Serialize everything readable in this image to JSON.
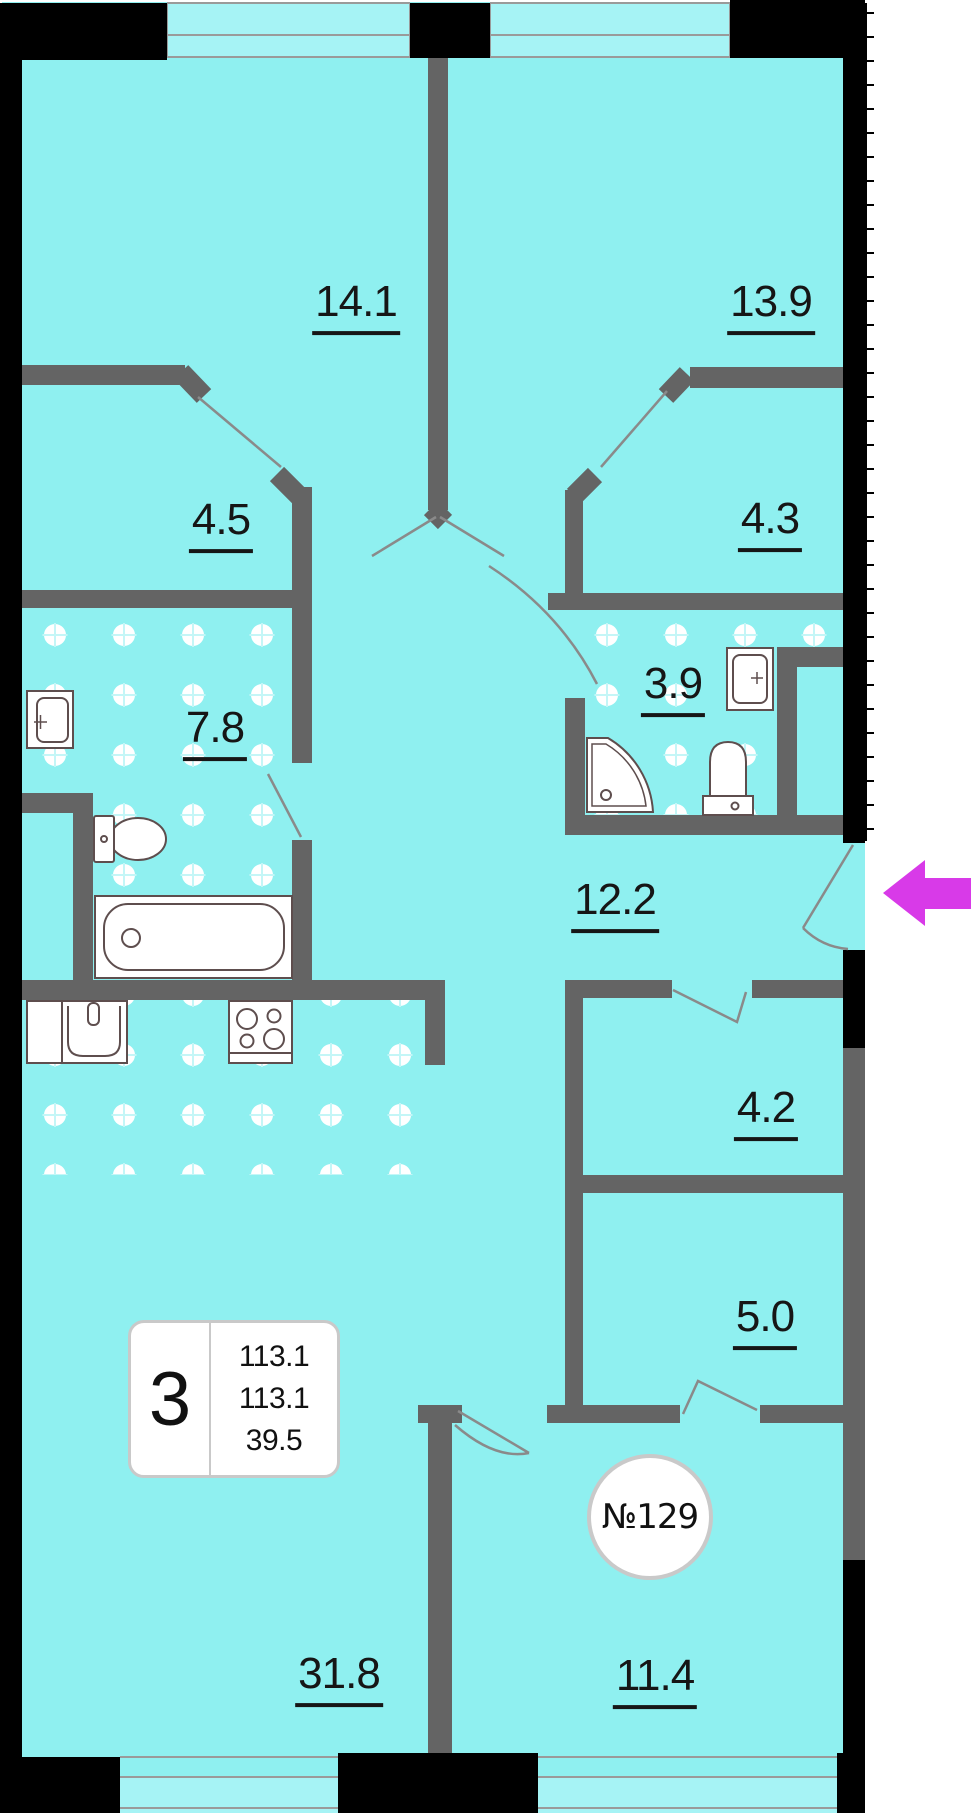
{
  "floor_plan": {
    "unit_number": "№129",
    "info_badge": {
      "rooms_count": "3",
      "values": [
        "113.1",
        "113.1",
        "39.5"
      ]
    },
    "room_areas": {
      "bedroom_top_left": "14.1",
      "bedroom_top_right": "13.9",
      "closet_left": "4.5",
      "closet_right": "4.3",
      "bathroom_small": "3.9",
      "bathroom_large": "7.8",
      "hallway": "12.2",
      "storage": "4.2",
      "wardrobe": "5.0",
      "living_kitchen": "31.8",
      "bedroom_bottom": "11.4"
    },
    "colors": {
      "floor": "#8FF0F0",
      "window_glass": "#A6F3F5",
      "outer_wall": "#000000",
      "inner_wall": "#646464",
      "door_line": "#8A8A8A",
      "fixture_outline": "#5E4E4E",
      "entrance_arrow": "#D83AE8"
    }
  }
}
